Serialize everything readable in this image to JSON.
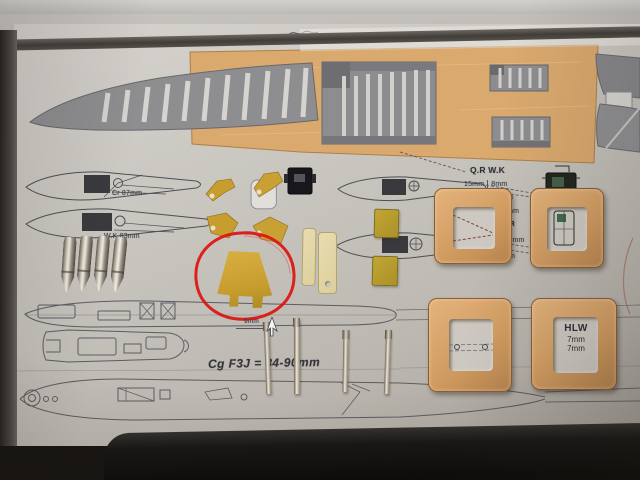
{
  "banner": {
    "brand": "V.J.V. VALENTA MODEL",
    "website": "www.valentamo"
  },
  "labels": {
    "root_chord": "Cr 87mm",
    "wing_chord": "W.K 83mm",
    "qr_wk_heading": "Q.R W.K",
    "qr_wk_v1": "15mm",
    "qr_wk_v2": "8mm",
    "qr_wk_v3": "6mm",
    "mid_value": "5mm",
    "wk_qr_heading": "W.K Q.R",
    "wk_qr_v1": "3mm",
    "wk_qr_v2": "1,5mm",
    "wk_qr_v3": "3mm",
    "canopy_width": "9mm",
    "cg_text": "Cg F3J = 84-90mm",
    "hlw_heading": "HLW",
    "hlw_v1": "7mm",
    "hlw_v2": "7mm"
  },
  "annotation": {
    "marker": "red hand-drawn circle around canopy part"
  },
  "colors": {
    "red_marker": "#dc1410",
    "balsa_sheet": "#d9a96e",
    "wood_frame": "#d3a068",
    "yellow_part": "#c79d30",
    "paper": "#c7c3bd",
    "background_wall": "#b3b0ab",
    "foreground_slab": "#141312"
  }
}
